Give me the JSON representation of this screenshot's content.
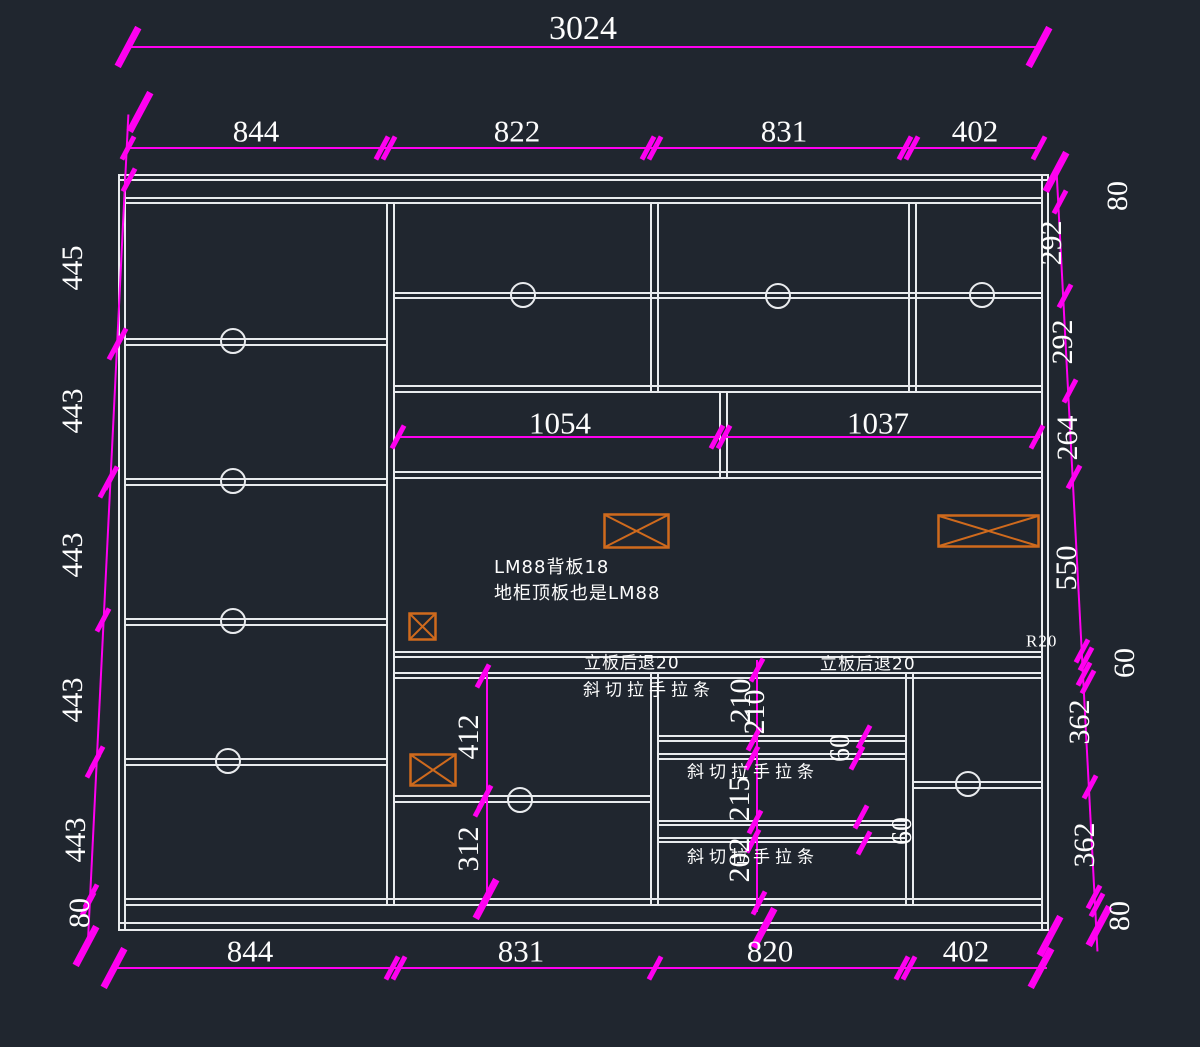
{
  "drawing": {
    "total_width_dim": "3024",
    "top_chain": [
      "844",
      "822",
      "831",
      "402"
    ],
    "bottom_chain": [
      "844",
      "831",
      "820",
      "402"
    ],
    "left_chain": [
      "445",
      "443",
      "443",
      "443",
      "443",
      "80"
    ],
    "right_chain": [
      "80",
      "292",
      "292",
      "264",
      "550",
      "60",
      "362",
      "362",
      "80"
    ],
    "middle_band_dims": [
      "1054",
      "1037"
    ],
    "lower_left_dims": [
      "412",
      "312"
    ],
    "drawer_dims": [
      "210",
      "210",
      "215",
      "202"
    ],
    "gap_dims": [
      "60",
      "60"
    ],
    "radius_label": "R20",
    "notes": {
      "backboard": "LM88背板18",
      "topboard": "地柜顶板也是LM88",
      "setback_left": "立板后退20",
      "setback_right": "立板后退20",
      "handle1": "斜切拉手拉条",
      "handle2": "斜切拉手拉条",
      "handle3": "斜切拉手拉条"
    },
    "colors": {
      "background": "#20262f",
      "outline": "#e9ebee",
      "dimension": "#ff00f0",
      "panel_box": "#cf6a1d"
    }
  }
}
